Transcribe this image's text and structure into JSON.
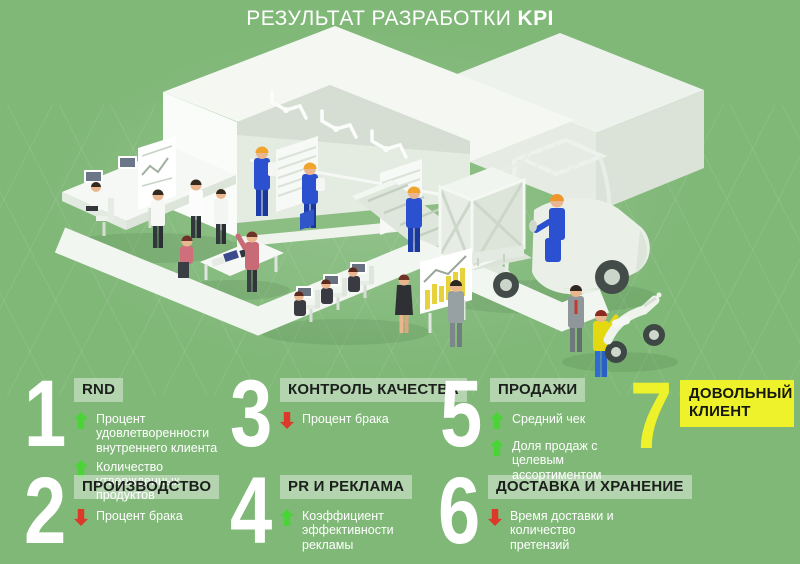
{
  "title": {
    "regular": "РЕЗУЛЬТАТ РАЗРАБОТКИ",
    "bold": "KPI"
  },
  "colors": {
    "background": "#80b878",
    "arrow_up": "#4bd438",
    "arrow_down": "#dd392b",
    "highlight_yellow": "#edf22a",
    "heading_bg": "#b7d7ac",
    "number": "#ffffff"
  },
  "icons": {
    "up": "block-arrow-up",
    "down": "block-arrow-down"
  },
  "kpi": [
    {
      "number": "1",
      "heading": "RND",
      "bullets": [
        {
          "direction": "up",
          "text": "Процент удовлетворенности внутреннего клиента"
        },
        {
          "direction": "up",
          "text": "Количество утвержденных продуктов"
        }
      ]
    },
    {
      "number": "2",
      "heading": "ПРОИЗВОДСТВО",
      "bullets": [
        {
          "direction": "down",
          "text": "Процент брака"
        }
      ]
    },
    {
      "number": "3",
      "heading": "КОНТРОЛЬ КАЧЕСТВА",
      "bullets": [
        {
          "direction": "down",
          "text": "Процент брака"
        }
      ]
    },
    {
      "number": "4",
      "heading": "PR И РЕКЛАМА",
      "bullets": [
        {
          "direction": "up",
          "text": "Коэффициент эффективности рекламы"
        }
      ]
    },
    {
      "number": "5",
      "heading": "ПРОДАЖИ",
      "bullets": [
        {
          "direction": "up",
          "text": "Средний чек"
        },
        {
          "direction": "up",
          "text": "Доля продаж с целевым ассортиментом"
        }
      ]
    },
    {
      "number": "6",
      "heading": "ДОСТАВКА И ХРАНЕНИЕ",
      "bullets": [
        {
          "direction": "down",
          "text": "Время доставки и количество претензий"
        }
      ]
    },
    {
      "number": "7",
      "heading": "ДОВОЛЬНЫЙ КЛИЕНТ",
      "highlighted": true,
      "bullets": []
    }
  ]
}
